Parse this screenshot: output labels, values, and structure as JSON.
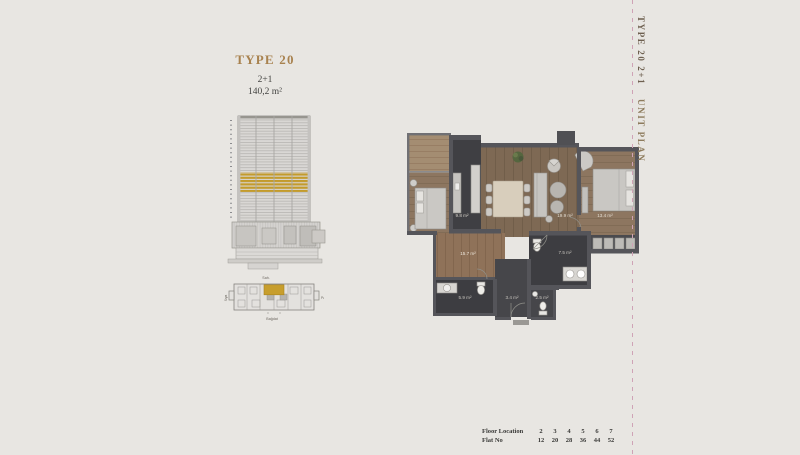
{
  "title": {
    "type_label": "TYPE 20",
    "config": "2+1",
    "area": "140,2 m²"
  },
  "side_label": {
    "part1": "TYPE 20  2+1",
    "part2": "UNIT PLAN"
  },
  "key_plan": {
    "top": "Sah.",
    "bottom": "Bağdat",
    "right": "Palm",
    "left": "Srya"
  },
  "rooms": [
    {
      "name": "kitchen-dining",
      "area": "9.8 m²"
    },
    {
      "name": "living-room",
      "area": "19.9 m²"
    },
    {
      "name": "bedroom-right",
      "area": "13.4 m²"
    },
    {
      "name": "entrance-hall",
      "area": "15.7 m²"
    },
    {
      "name": "bathroom",
      "area": "5.9 m²"
    },
    {
      "name": "hallway",
      "area": "3.4 m²"
    },
    {
      "name": "master-bathroom",
      "area": "7.5 m²"
    },
    {
      "name": "wc",
      "area": "2.5 m²"
    }
  ],
  "floor_table": {
    "rows": [
      {
        "label": "Floor Location",
        "values": [
          "2",
          "3",
          "4",
          "5",
          "6",
          "7"
        ]
      },
      {
        "label": "Flat No",
        "values": [
          "12",
          "20",
          "28",
          "36",
          "44",
          "52"
        ]
      }
    ]
  },
  "colors": {
    "accent_gold": "#c49d2e",
    "dashed_line": "#cfa3b6",
    "title_gold": "#a8824f",
    "wall": "#55555a"
  }
}
